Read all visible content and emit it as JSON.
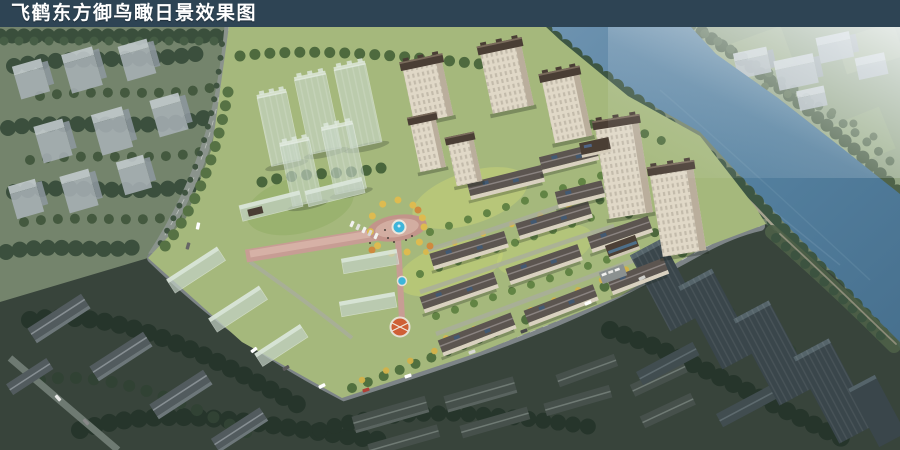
{
  "title_bar": {
    "text": "飞鹤东方御鸟瞰日景效果图",
    "bg": "#2e4454",
    "fg": "#ffffff"
  },
  "image": {
    "kind": "aerial daytime architectural rendering",
    "subject": "riverside residential development: high-rise towers and mid-rise apartment rows around a landscaped central plaza with fountain, translucent massing blocks for future phases, river with far shore at upper right, darker city context surrounding the site"
  },
  "palette": {
    "title_bar_bg": "#2e4454",
    "title_text": "#ffffff",
    "context_ground": "#74846c",
    "far_shore": "#93a584",
    "river_deep": "#47708e",
    "river_light": "#6e93b0",
    "dark_foreground": "#38443b",
    "site_green": "#a5b87c",
    "tree_dark": "#3b4f3d",
    "tree_yellow": "#d2b14a",
    "building_wall": "#e0d8c7",
    "building_roof": "#4a3e35",
    "glass_massing": "#c9d8ca",
    "context_block": "#aab2b8",
    "dark_tower": "#3a464b",
    "road": "#7d8487",
    "path_pink": "#c79d94",
    "pool_blue": "#3eb5da",
    "haze": "#edf2f6"
  }
}
